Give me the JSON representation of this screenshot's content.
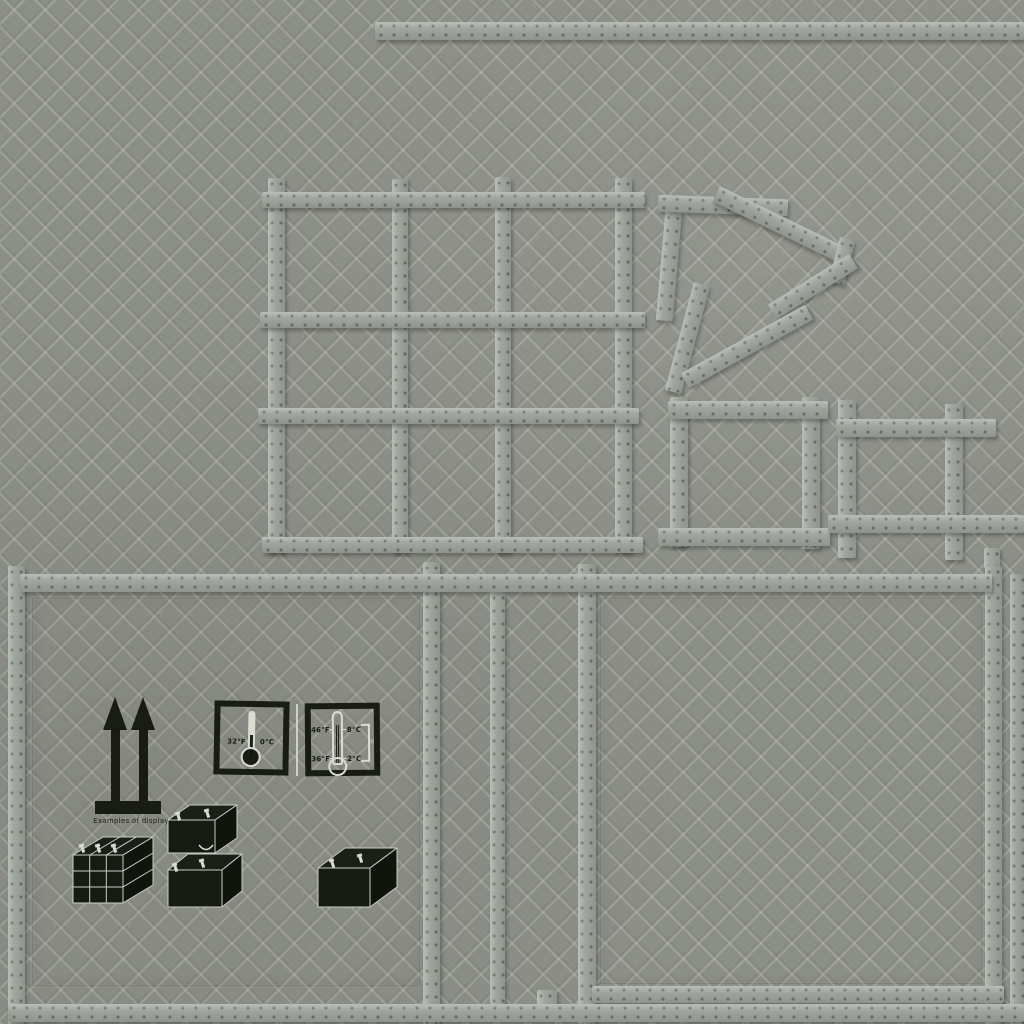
{
  "texture": {
    "type": "crate-texture-sheet",
    "background_color": "#8c8f87",
    "tape_color": "#9ea59d",
    "ink_color": "#14180f",
    "stencil_light_color": "#d9ddd0",
    "pictograms": {
      "caption": "Examples of display",
      "therm_freeze": {
        "fahrenheit": "32°F",
        "celsius": "0°C"
      },
      "therm_range": {
        "upper_fahrenheit": "46°F",
        "upper_celsius": "8°C",
        "lower_fahrenheit": "36°F",
        "lower_celsius": "2°C"
      }
    }
  }
}
